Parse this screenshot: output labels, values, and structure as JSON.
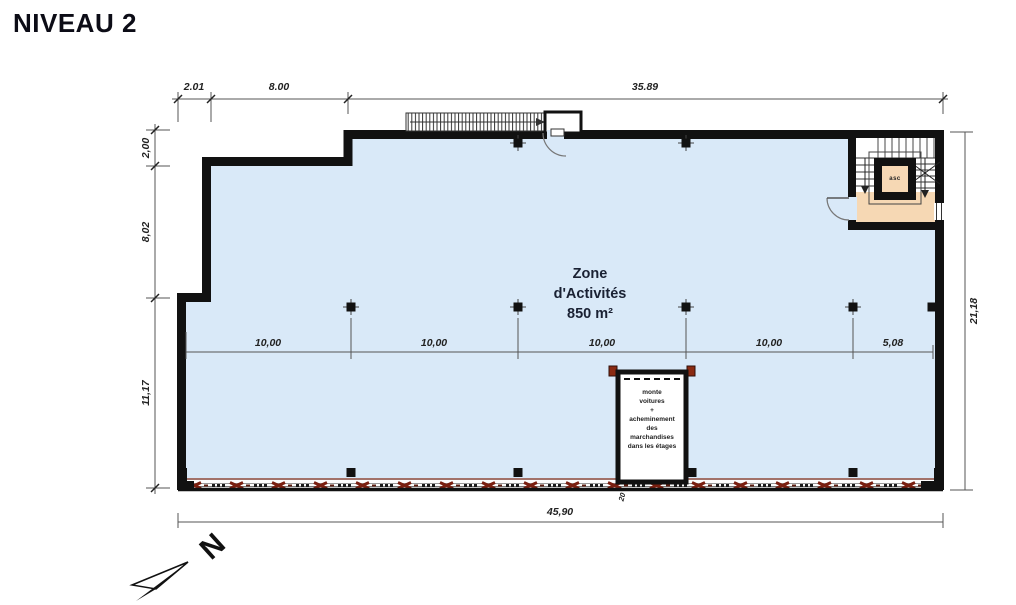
{
  "title": "NIVEAU 2",
  "zone": {
    "name_line1": "Zone",
    "name_line2": "d'Activités",
    "area": "850 m²"
  },
  "elevator": {
    "label": "asc"
  },
  "car_lift": {
    "lines": [
      "monte",
      "voitures",
      "+",
      "acheminement",
      "des",
      "marchandises",
      "dans les étages"
    ],
    "dim_label": "20"
  },
  "compass": {
    "label": "N"
  },
  "dims": {
    "top": [
      "2.01",
      "8.00",
      "35.89"
    ],
    "left": [
      "2,00",
      "8,02",
      "11,17"
    ],
    "right_total": "21,18",
    "bottom_total": "45,90",
    "interior": [
      "10,00",
      "10,00",
      "10,00",
      "10,00",
      "5,08"
    ]
  },
  "colors": {
    "zone_fill": "#d9e9f8",
    "core_fill": "#f6d8b4",
    "wall": "#111111",
    "facade_marks": "#7a1f10"
  }
}
